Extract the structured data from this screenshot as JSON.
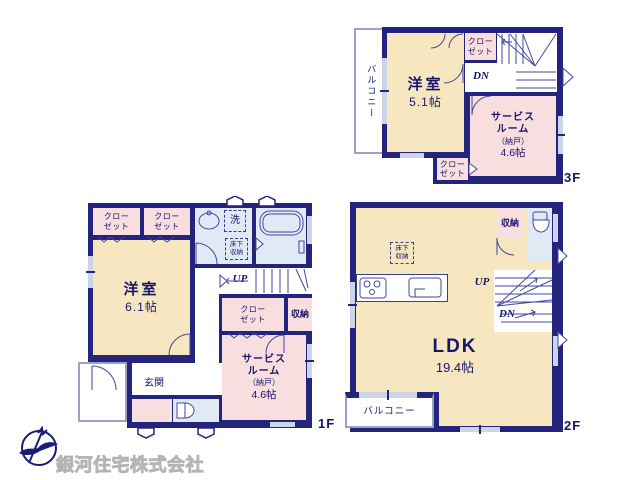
{
  "title": "間取り図 (floor plan)",
  "colors": {
    "wall": "#24247c",
    "room_cream": "#f6e7c0",
    "room_pink": "#f8dede",
    "room_blue": "#dfeaf5",
    "line": "#4646a0",
    "window": "#ccd4e8",
    "text": "#16166b",
    "watermark": "#c9c9c9"
  },
  "floors": {
    "f3": {
      "label": "3F",
      "balcony": "バルコニー",
      "yoshitsu": {
        "name": "洋室",
        "size": "5.1帖"
      },
      "closet_top": "クロー\nゼット",
      "closet_bottom": "クロー\nゼット",
      "service": {
        "name": "サービス\nルーム",
        "sub": "（納戸）",
        "size": "4.6帖"
      },
      "dn": "DN"
    },
    "f1": {
      "label": "1F",
      "closet_a": "クロー\nゼット",
      "closet_b": "クロー\nゼット",
      "washer": "洗",
      "underfloor": "床下\n収納",
      "yoshitsu": {
        "name": "洋室",
        "size": "6.1帖"
      },
      "up": "UP",
      "closet_c": "クロー\nゼット",
      "storage": "収納",
      "service": {
        "name": "サービス\nルーム",
        "sub": "（納戸）",
        "size": "4.6帖"
      },
      "entrance": "玄関"
    },
    "f2": {
      "label": "2F",
      "storage": "収納",
      "underfloor": "床下\n収納",
      "ldk": {
        "name": "LDK",
        "size": "19.4帖"
      },
      "up": "UP",
      "dn": "DN",
      "balcony": "バルコニー"
    }
  },
  "branding": {
    "company": "銀河住宅株式会社",
    "compass_n": "N"
  },
  "icons": [
    "compass-north-icon",
    "bird-logo-icon",
    "bathtub-icon",
    "washbasin-icon",
    "toilet-icon",
    "stove-icon",
    "kitchen-sink-icon",
    "vent-icon",
    "door-arc-icon",
    "stairs-icon",
    "casement-window-icon"
  ]
}
